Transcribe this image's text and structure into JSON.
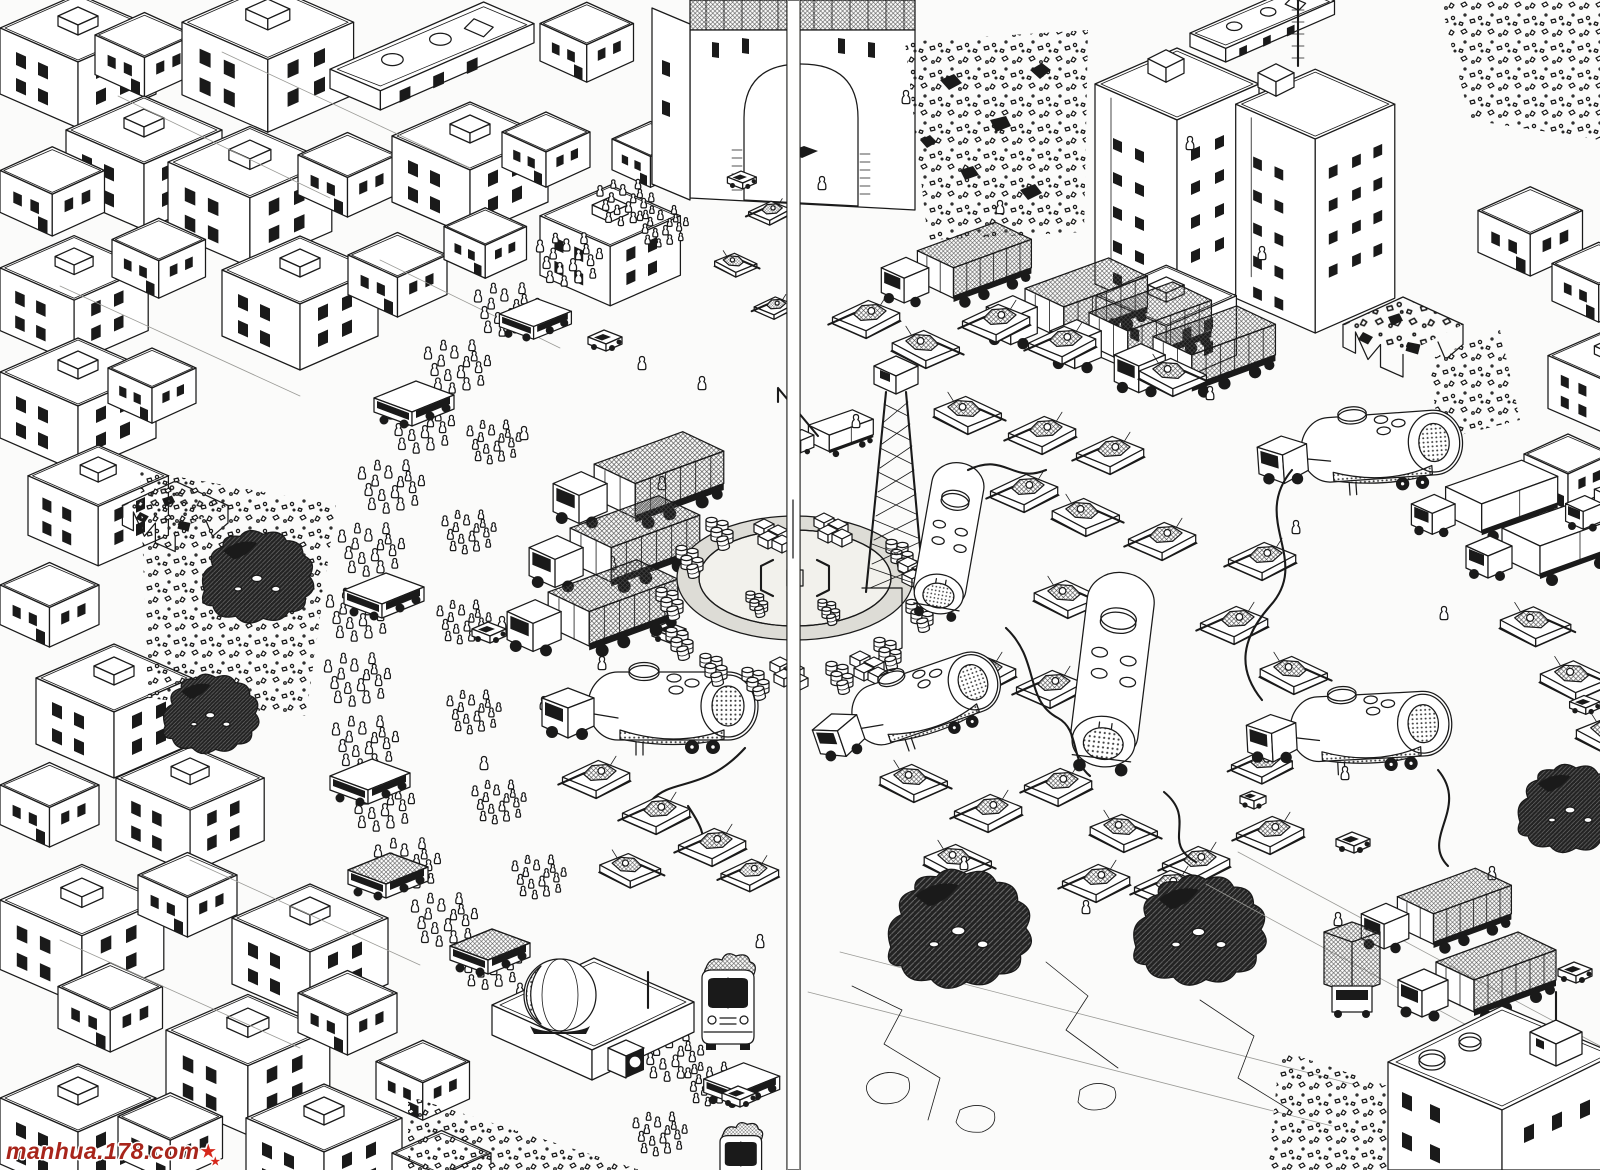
{
  "page": {
    "paper_color": "#fbfbfa",
    "ink_color": "#1a1a1a",
    "halftone_color": "#8d8d8d"
  },
  "watermark": {
    "text": "manhua.178.com",
    "color": "#a8251b",
    "star_big": "★",
    "star_small": "★"
  }
}
